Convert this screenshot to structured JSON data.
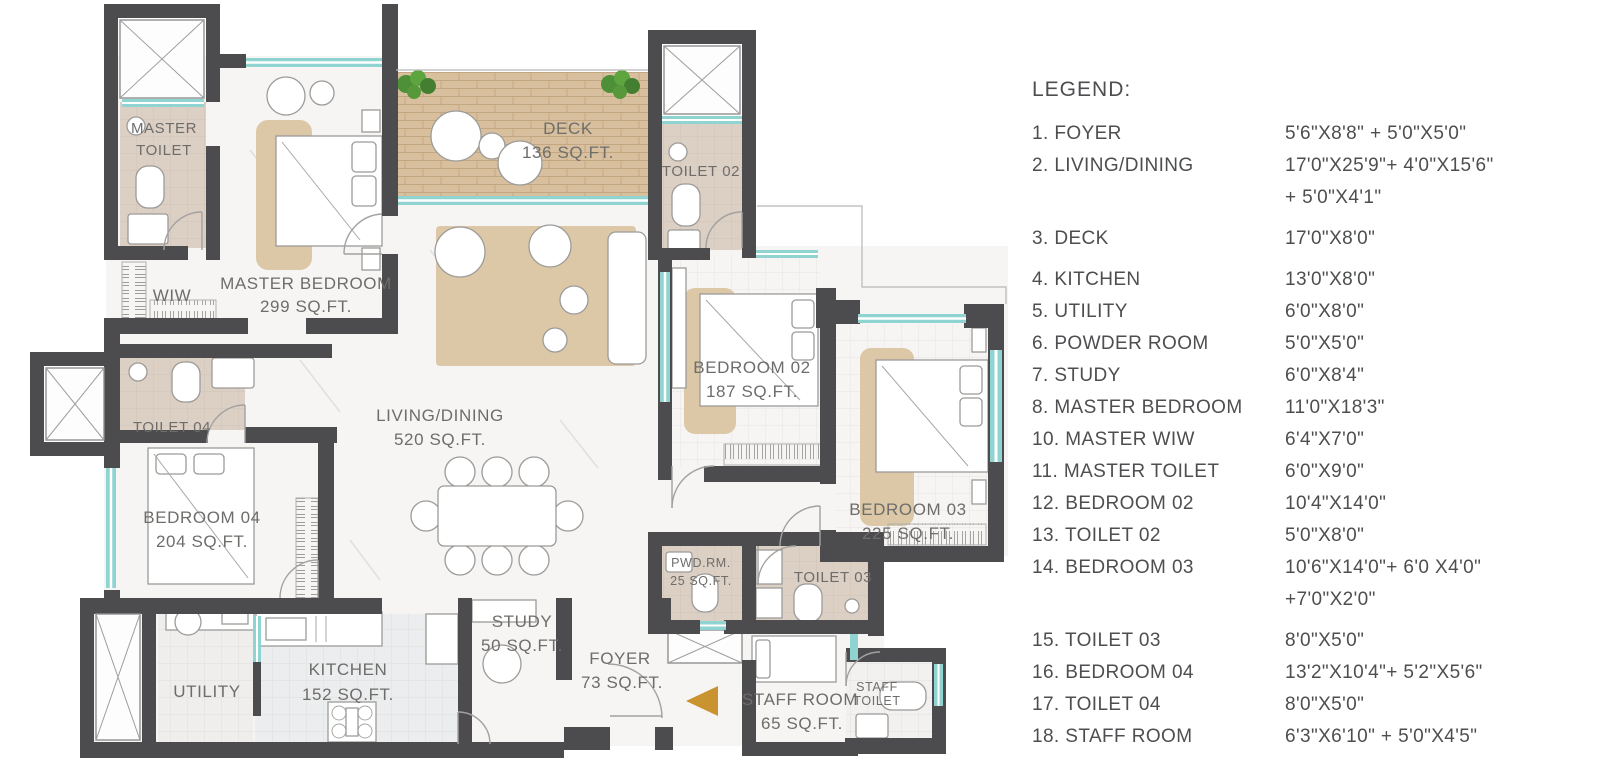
{
  "legend": {
    "title": "LEGEND:",
    "items": [
      {
        "num": "1.",
        "name": "FOYER",
        "dims": "5'6\"X8'8\" + 5'0\"X5'0\"",
        "dims2": "",
        "gap": false
      },
      {
        "num": "2.",
        "name": "LIVING/DINING",
        "dims": "17'0\"X25'9\"+ 4'0\"X15'6\"",
        "dims2": "+ 5'0\"X4'1\"",
        "gap": false
      },
      {
        "num": "3.",
        "name": "DECK",
        "dims": "17'0\"X8'0\"",
        "dims2": "",
        "gap": true
      },
      {
        "num": "4.",
        "name": "KITCHEN",
        "dims": "13'0\"X8'0\"",
        "dims2": "",
        "gap": true
      },
      {
        "num": "5.",
        "name": "UTILITY",
        "dims": "6'0\"X8'0\"",
        "dims2": "",
        "gap": false
      },
      {
        "num": "6.",
        "name": "POWDER ROOM",
        "dims": "5'0\"X5'0\"",
        "dims2": "",
        "gap": false
      },
      {
        "num": "7.",
        "name": "STUDY",
        "dims": "6'0\"X8'4\"",
        "dims2": "",
        "gap": false
      },
      {
        "num": "8.",
        "name": "MASTER BEDROOM",
        "dims": "11'0\"X18'3\"",
        "dims2": "",
        "gap": false
      },
      {
        "num": "10.",
        "name": "MASTER WIW",
        "dims": "6'4\"X7'0\"",
        "dims2": "",
        "gap": false
      },
      {
        "num": "11.",
        "name": "MASTER TOILET",
        "dims": "6'0\"X9'0\"",
        "dims2": "",
        "gap": false
      },
      {
        "num": "12.",
        "name": "BEDROOM 02",
        "dims": "10'4\"X14'0\"",
        "dims2": "",
        "gap": false
      },
      {
        "num": "13.",
        "name": "TOILET 02",
        "dims": "5'0\"X8'0\"",
        "dims2": "",
        "gap": false
      },
      {
        "num": "14.",
        "name": "BEDROOM 03",
        "dims": "10'6\"X14'0\"+ 6'0 X4'0\"",
        "dims2": "+7'0\"X2'0\"",
        "gap": false
      },
      {
        "num": "15.",
        "name": "TOILET 03",
        "dims": "8'0\"X5'0\"",
        "dims2": "",
        "gap": true
      },
      {
        "num": "16.",
        "name": "BEDROOM 04",
        "dims": "13'2\"X10'4\"+ 5'2\"X5'6\"",
        "dims2": "",
        "gap": false
      },
      {
        "num": "17.",
        "name": "TOILET 04",
        "dims": "8'0\"X5'0\"",
        "dims2": "",
        "gap": false
      },
      {
        "num": "18.",
        "name": "STAFF ROOM",
        "dims": "6'3\"X6'10\" + 5'0\"X4'5\"",
        "dims2": "",
        "gap": false
      }
    ]
  },
  "rooms": {
    "master_toilet": {
      "line1": "MASTER",
      "line2": "TOILET"
    },
    "wiw": {
      "name": "WIW"
    },
    "master_bedroom": {
      "name": "MASTER BEDROOM",
      "area": "299 SQ.FT."
    },
    "deck": {
      "name": "DECK",
      "area": "136 SQ.FT."
    },
    "toilet_02": {
      "name": "TOILET 02"
    },
    "bedroom_02": {
      "name": "BEDROOM 02",
      "area": "187 SQ.FT."
    },
    "bedroom_03": {
      "name": "BEDROOM 03",
      "area": "225 SQ.FT."
    },
    "living_dining": {
      "name": "LIVING/DINING",
      "area": "520 SQ.FT."
    },
    "toilet_04": {
      "name": "TOILET 04"
    },
    "bedroom_04": {
      "name": "BEDROOM 04",
      "area": "204 SQ.FT."
    },
    "utility": {
      "name": "UTILITY"
    },
    "kitchen": {
      "name": "KITCHEN",
      "area": "152 SQ.FT."
    },
    "study": {
      "name": "STUDY",
      "area": "50 SQ.FT."
    },
    "foyer": {
      "name": "FOYER",
      "area": "73 SQ.FT."
    },
    "pwd_rm": {
      "name": "PWD.RM.",
      "area": "25 SQ.FT."
    },
    "toilet_03": {
      "name": "TOILET 03"
    },
    "staff_room": {
      "name": "STAFF ROOM",
      "area": "65 SQ.FT."
    },
    "staff_toilet": {
      "line1": "STAFF",
      "line2": "TOILET"
    }
  },
  "colors": {
    "wall": "#4c4b4d",
    "window_teal": "#8fd4d0",
    "bath_floor": "#dccfc3",
    "deck_wood": "#d8c09e",
    "rug_tan": "#dcc8a7",
    "entry_arrow_gold": "#c9932f",
    "plant_green": "#4e9038",
    "label_gray": "#6e6d6b"
  }
}
